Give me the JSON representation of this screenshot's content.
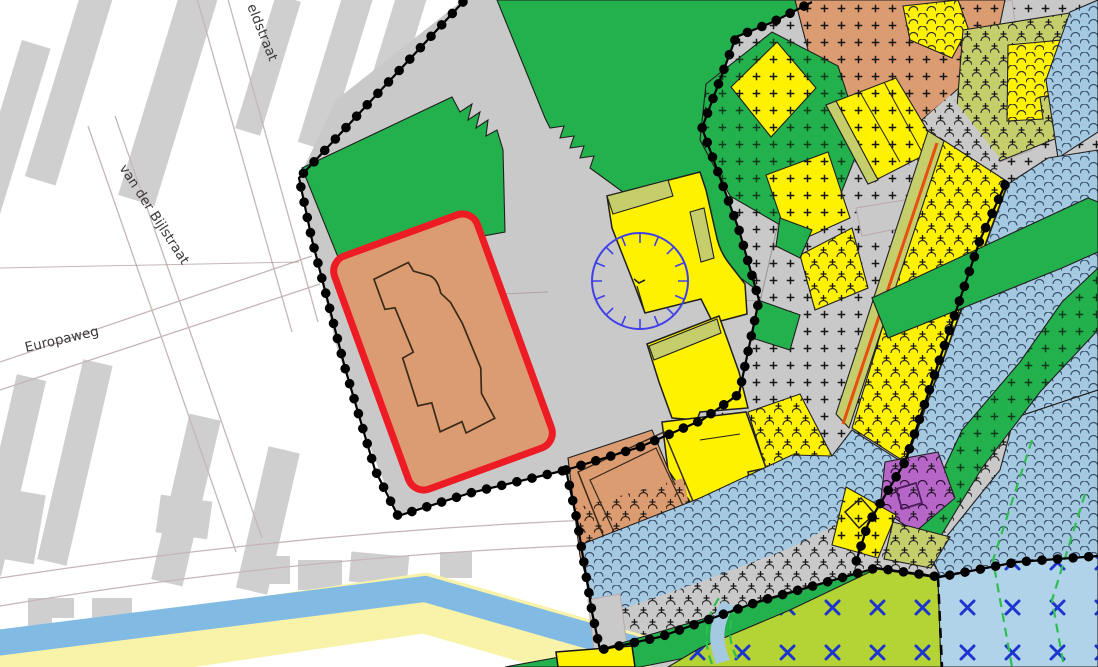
{
  "streets": {
    "street_top": "eldstraat",
    "street_left": "van der Bijlstraat",
    "street_bottom_left": "Europaweg"
  },
  "colors": {
    "white": "#ffffff",
    "plan_gray": "#c9c9c9",
    "building_gray": "#cfcfcf",
    "road_line": "#c7b6b6",
    "green": "#23b14d",
    "yellow": "#fff200",
    "pale_yellow": "#f9f3a9",
    "canal_blue": "#81bbe4",
    "light_blue": "#a6c9e2",
    "x_light_blue": "#b0d3ea",
    "yellow_green": "#b4d334",
    "olive": "#c6ce6b",
    "salmon": "#dc9c72",
    "purple": "#b566c6",
    "red_highlight": "#ed1c24",
    "accent_orange": "#e84e0f",
    "circle_blue": "#4040e8",
    "x_mark_blue": "#1d35cf",
    "boundary_black": "#000000",
    "label_gray": "#3b3b3b"
  }
}
